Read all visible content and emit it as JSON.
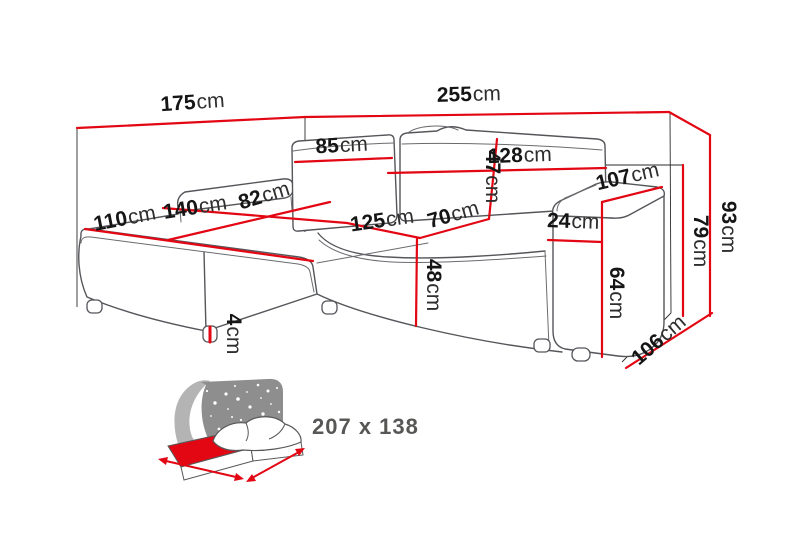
{
  "page": {
    "background": "#ffffff"
  },
  "colors": {
    "dimension_red": "#e30613",
    "sofa_outline_gray": "#55565a",
    "label_number_black": "#151515",
    "label_unit_black": "#2e2e2e",
    "icon_dark_gray": "#8e8e8e",
    "icon_light_gray": "#b4b4b4",
    "icon_text_gray": "#575756"
  },
  "diagram": {
    "subject": "corner-sofa-dimension-drawing",
    "unit": "cm",
    "measurements": [
      {
        "id": "total-depth-left",
        "value": "175",
        "unit": "cm"
      },
      {
        "id": "total-width",
        "value": "255",
        "unit": "cm"
      },
      {
        "id": "back-cushion-left-width",
        "value": "85",
        "unit": "cm"
      },
      {
        "id": "back-cushion-right-width",
        "value": "128",
        "unit": "cm"
      },
      {
        "id": "backrest-height",
        "value": "47",
        "unit": "cm"
      },
      {
        "id": "armrest-depth",
        "value": "107",
        "unit": "cm"
      },
      {
        "id": "chaise-seat-depth",
        "value": "82",
        "unit": "cm"
      },
      {
        "id": "chaise-length",
        "value": "140",
        "unit": "cm"
      },
      {
        "id": "chaise-front-width",
        "value": "110",
        "unit": "cm"
      },
      {
        "id": "seat-width",
        "value": "125",
        "unit": "cm"
      },
      {
        "id": "seat-depth",
        "value": "70",
        "unit": "cm"
      },
      {
        "id": "armrest-width",
        "value": "24",
        "unit": "cm"
      },
      {
        "id": "total-height",
        "value": "93",
        "unit": "cm"
      },
      {
        "id": "side-height",
        "value": "79",
        "unit": "cm"
      },
      {
        "id": "armrest-height",
        "value": "64",
        "unit": "cm"
      },
      {
        "id": "seat-height",
        "value": "48",
        "unit": "cm"
      },
      {
        "id": "side-depth",
        "value": "106",
        "unit": "cm"
      },
      {
        "id": "leg-height",
        "value": "4",
        "unit": "cm"
      }
    ],
    "sleeping_area": {
      "dimensions": "207 x 138"
    }
  }
}
